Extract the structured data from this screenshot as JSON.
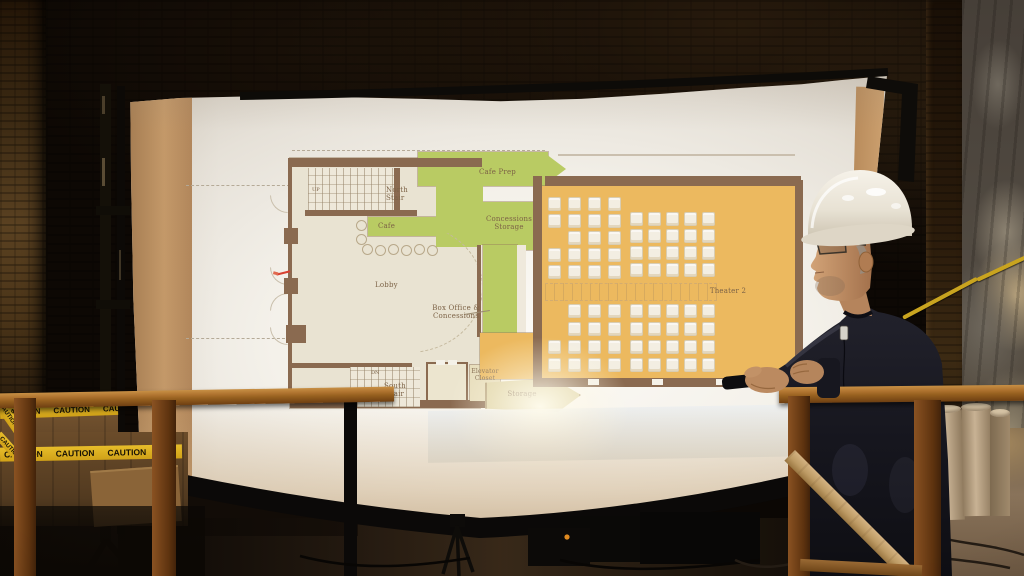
{
  "scene": {
    "palette": {
      "brick_dark": "#140d06",
      "brick_lit": "#4a3319",
      "screen_white": "#f4f1ea",
      "cardboard_band": "#c79a68",
      "plan_wall_brown": "#8a6a50",
      "plan_green": "#b9cb63",
      "plan_orange": "#ecb95f",
      "plan_cream": "#e9e3d2",
      "plan_storage_tan": "#ded3a6",
      "seat_fill": "#f3eee2",
      "label_ink": "#7c6246",
      "rail_wood": "#b07430",
      "brace_wood": "#bd9a64",
      "caution_yellow": "#d9ab1e",
      "hardhat_white": "#ece7dc",
      "skin": "#c8996e",
      "sweater_dark": "#17171f",
      "laser_red": "#d84030",
      "extension_cord_yellow": "#c9a41f",
      "tube_cardboard": "#c8b294"
    }
  },
  "plan": {
    "labels": {
      "north_stair": "North\nStair",
      "cafe": "Cafe",
      "cafe_prep": "Cafe Prep",
      "concessions_storage": "Concessions\nStorage",
      "lobby": "Lobby",
      "box_office": "Box Office &\nConcessions",
      "theater2": "Theater 2",
      "south_stair": "South\nStair",
      "elevator_closet": "Elevator\nCloset",
      "storage": "Storage",
      "up": "UP",
      "dn": "DN"
    },
    "seats": {
      "block_w": 13,
      "block_h": 14,
      "columns": [
        {
          "x": 420,
          "rows": [
            122,
            139,
            173,
            190,
            265,
            283
          ]
        },
        {
          "x": 440,
          "rows": [
            122,
            139,
            156,
            173,
            190,
            229,
            247,
            265,
            283
          ]
        },
        {
          "x": 460,
          "rows": [
            122,
            139,
            156,
            173,
            190,
            229,
            247,
            265,
            283
          ]
        },
        {
          "x": 480,
          "rows": [
            122,
            139,
            156,
            173,
            190,
            229,
            247,
            265,
            283
          ]
        },
        {
          "x": 502,
          "rows": [
            137,
            154,
            171,
            188,
            229,
            247,
            265,
            283
          ]
        },
        {
          "x": 520,
          "rows": [
            137,
            154,
            171,
            188,
            229,
            247,
            265,
            283
          ]
        },
        {
          "x": 538,
          "rows": [
            137,
            154,
            171,
            188,
            229,
            247,
            265,
            283
          ]
        },
        {
          "x": 556,
          "rows": [
            137,
            154,
            171,
            188,
            229,
            247,
            265,
            283
          ]
        },
        {
          "x": 574,
          "rows": [
            137,
            154,
            171,
            188,
            229,
            247,
            265,
            283
          ]
        }
      ]
    }
  },
  "signs": {
    "caution": "CAUTION"
  }
}
